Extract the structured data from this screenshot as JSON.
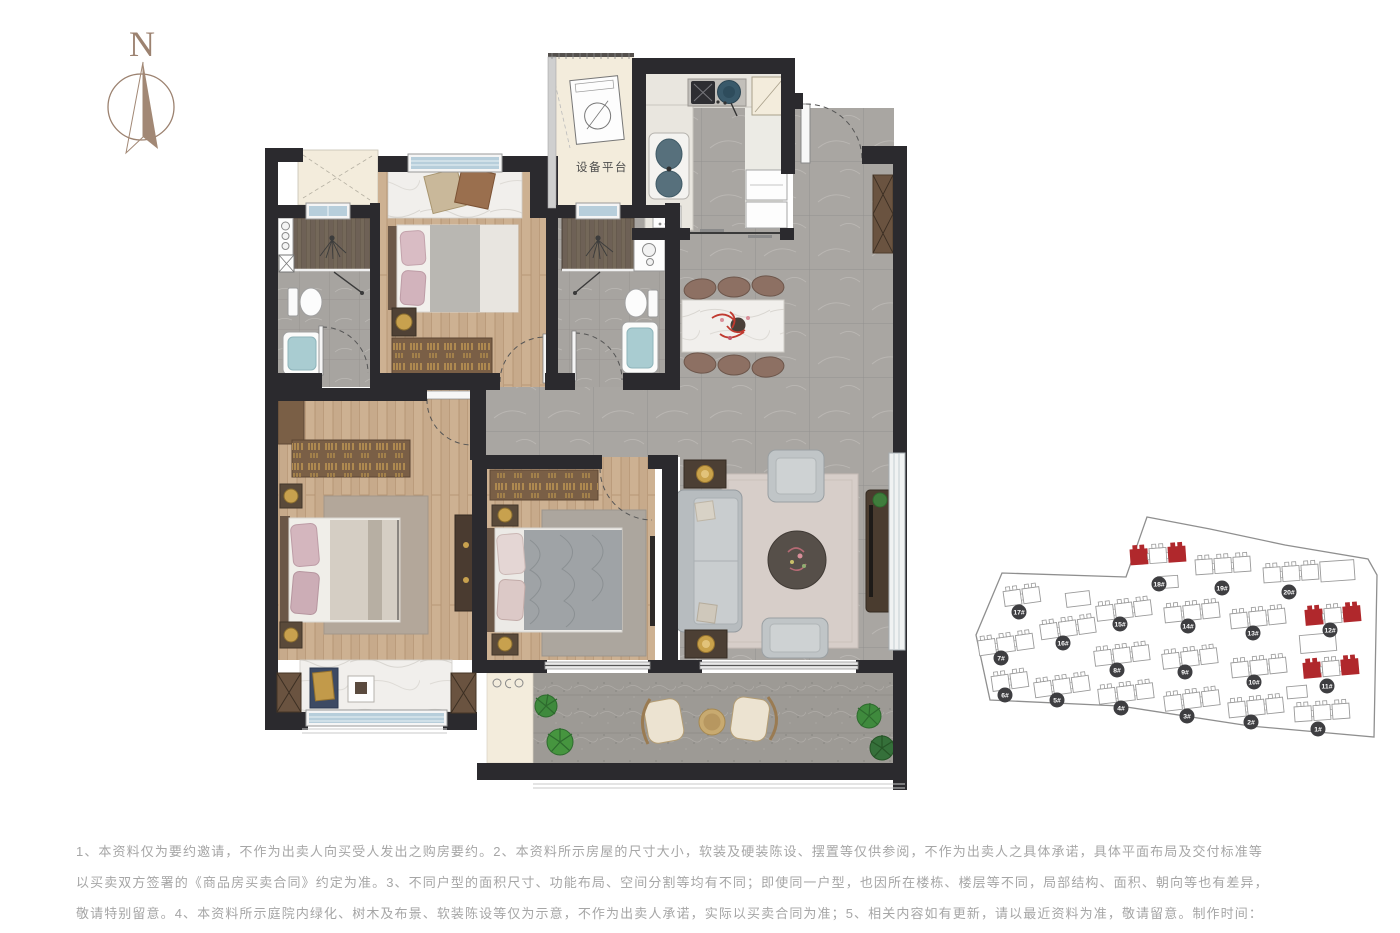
{
  "compass": {
    "label": "N"
  },
  "floor_plan": {
    "equipment_platform_label": "设备平台",
    "colors": {
      "wall": "#2b2a2e",
      "wood": "#c7aa8b",
      "tile": "#a9a6a2",
      "cream": "#f3ecdc",
      "window": "#b7cedb",
      "plant": "#3f8a3d"
    }
  },
  "site_plan": {
    "colors": {
      "highlight": "#b0282c",
      "badge": "#3e3e41",
      "outline": "#8f8f8f"
    },
    "boundary": [
      [
        1147,
        517
      ],
      [
        1210,
        529
      ],
      [
        1285,
        545
      ],
      [
        1368,
        559
      ],
      [
        1377,
        575
      ],
      [
        1374,
        737
      ],
      [
        1250,
        726
      ],
      [
        1120,
        706
      ],
      [
        990,
        700
      ],
      [
        976,
        635
      ],
      [
        1002,
        573
      ],
      [
        1126,
        577
      ]
    ],
    "buildings": [
      {
        "label": "18#",
        "x": 1158,
        "y": 556,
        "rot": -4,
        "units": 3,
        "red": true,
        "lx": 1159,
        "ly": 584
      },
      {
        "label": "19#",
        "x": 1223,
        "y": 566,
        "rot": -4,
        "units": 3,
        "red": false,
        "lx": 1222,
        "ly": 588
      },
      {
        "label": "20#",
        "x": 1291,
        "y": 574,
        "rot": -4,
        "units": 3,
        "red": false,
        "wide": true,
        "lx": 1289,
        "ly": 592
      },
      {
        "label": "17#",
        "x": 1022,
        "y": 597,
        "rot": -8,
        "units": 2,
        "red": false,
        "lx": 1019,
        "ly": 612
      },
      {
        "label": "15#",
        "x": 1124,
        "y": 611,
        "rot": -7,
        "units": 3,
        "red": false,
        "lx": 1120,
        "ly": 624
      },
      {
        "label": "14#",
        "x": 1192,
        "y": 613,
        "rot": -6,
        "units": 3,
        "red": false,
        "lx": 1188,
        "ly": 626
      },
      {
        "label": "13#",
        "x": 1258,
        "y": 619,
        "rot": -6,
        "units": 3,
        "red": false,
        "lx": 1253,
        "ly": 633
      },
      {
        "label": "12#",
        "x": 1333,
        "y": 616,
        "rot": -5,
        "units": 3,
        "red": true,
        "lx": 1330,
        "ly": 630
      },
      {
        "label": "16#",
        "x": 1068,
        "y": 629,
        "rot": -8,
        "units": 3,
        "red": false,
        "lx": 1063,
        "ly": 643
      },
      {
        "label": "7#",
        "x": 1006,
        "y": 645,
        "rot": -8,
        "units": 3,
        "red": false,
        "lx": 1001,
        "ly": 658
      },
      {
        "label": "8#",
        "x": 1122,
        "y": 656,
        "rot": -7,
        "units": 3,
        "red": false,
        "lx": 1117,
        "ly": 670
      },
      {
        "label": "9#",
        "x": 1190,
        "y": 659,
        "rot": -7,
        "units": 3,
        "red": false,
        "lx": 1185,
        "ly": 672
      },
      {
        "label": "10#",
        "x": 1259,
        "y": 668,
        "rot": -6,
        "units": 3,
        "red": false,
        "lx": 1254,
        "ly": 682
      },
      {
        "label": "11#",
        "x": 1331,
        "y": 669,
        "rot": -5,
        "units": 3,
        "red": true,
        "lx": 1327,
        "ly": 686
      },
      {
        "label": "6#",
        "x": 1010,
        "y": 682,
        "rot": -8,
        "units": 2,
        "red": false,
        "lx": 1005,
        "ly": 695
      },
      {
        "label": "5#",
        "x": 1062,
        "y": 687,
        "rot": -8,
        "units": 3,
        "red": false,
        "lx": 1057,
        "ly": 700
      },
      {
        "label": "4#",
        "x": 1126,
        "y": 694,
        "rot": -7,
        "units": 3,
        "red": false,
        "lx": 1121,
        "ly": 708
      },
      {
        "label": "3#",
        "x": 1192,
        "y": 701,
        "rot": -7,
        "units": 3,
        "red": false,
        "lx": 1187,
        "ly": 716
      },
      {
        "label": "2#",
        "x": 1256,
        "y": 708,
        "rot": -6,
        "units": 3,
        "red": false,
        "lx": 1251,
        "ly": 722
      },
      {
        "label": "1#",
        "x": 1322,
        "y": 713,
        "rot": -4,
        "units": 3,
        "red": false,
        "lx": 1318,
        "ly": 729
      }
    ],
    "extra_blocks": [
      {
        "x": 1078,
        "y": 599,
        "w": 24,
        "h": 14,
        "rot": -7
      },
      {
        "x": 1168,
        "y": 582,
        "w": 20,
        "h": 12,
        "rot": -4
      },
      {
        "x": 1318,
        "y": 643,
        "w": 36,
        "h": 18,
        "rot": -5
      },
      {
        "x": 1297,
        "y": 692,
        "w": 20,
        "h": 12,
        "rot": -5
      }
    ]
  },
  "disclaimer": {
    "lines": [
      "1、本资料仅为要约邀请，不作为出卖人向买受人发出之购房要约。2、本资料所示房屋的尺寸大小，软装及硬装陈设、摆置等仅供参阅，不作为出卖人之具体承诺，具体平面布局及交付标准等",
      "以买卖双方签署的《商品房买卖合同》约定为准。3、不同户型的面积尺寸、功能布局、空间分割等均有不同；即使同一户型，也因所在楼栋、楼层等不同，局部结构、面积、朝向等也有差异，",
      "敬请特别留意。4、本资料所示庭院内绿化、树木及布景、软装陈设等仅为示意，不作为出卖人承诺，实际以买卖合同为准；5、相关内容如有更新，请以最近资料为准，敬请留意。制作时间：",
      "2021年3月，有效期1个月。"
    ]
  }
}
